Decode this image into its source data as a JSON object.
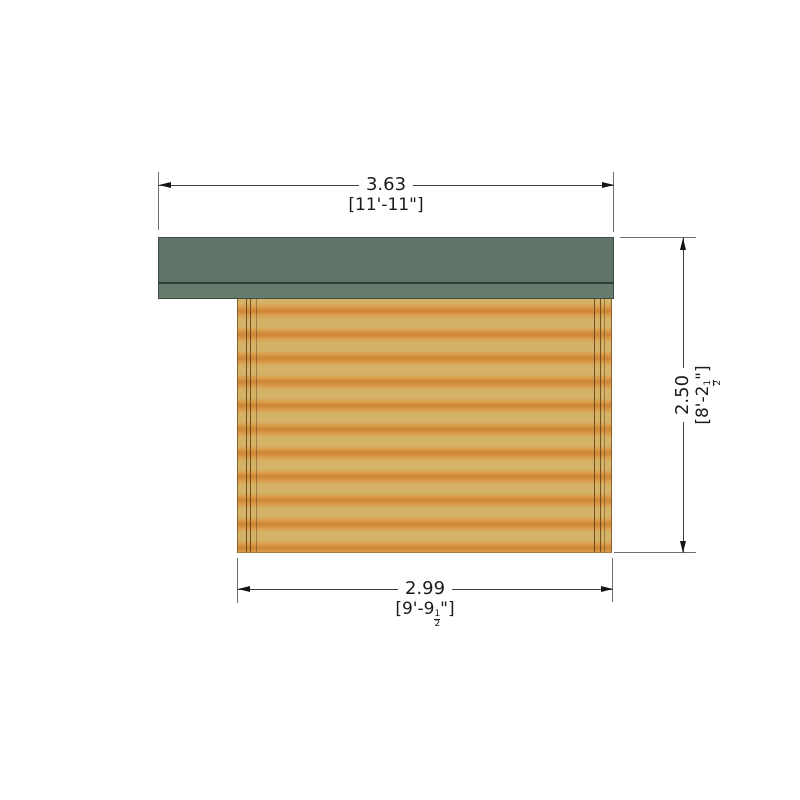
{
  "drawing": {
    "kind": "cabin-side-elevation",
    "colors": {
      "roof_main": "#5f7466",
      "roof_fascia": "#687c6d",
      "roof_edge": "#3e4d43",
      "wall_light": "#d4b369",
      "wall_band": "#cd8636",
      "post_line": "#5e4016",
      "dim_line": "#3f3f3f",
      "extension_line": "#6e6e6e",
      "text": "#1b1b1b",
      "background": "#ffffff"
    }
  },
  "dimensions": {
    "top": {
      "metric": "3.63",
      "imperial": "[11'-11\"]"
    },
    "right": {
      "metric": "2.50",
      "imperial_prefix": "[8'-2",
      "frac_num": "1",
      "frac_den": "2",
      "imperial_suffix": "\"]"
    },
    "bottom": {
      "metric": "2.99",
      "imperial_prefix": "[9'-9",
      "frac_num": "1",
      "frac_den": "2",
      "imperial_suffix": "\"]"
    }
  }
}
